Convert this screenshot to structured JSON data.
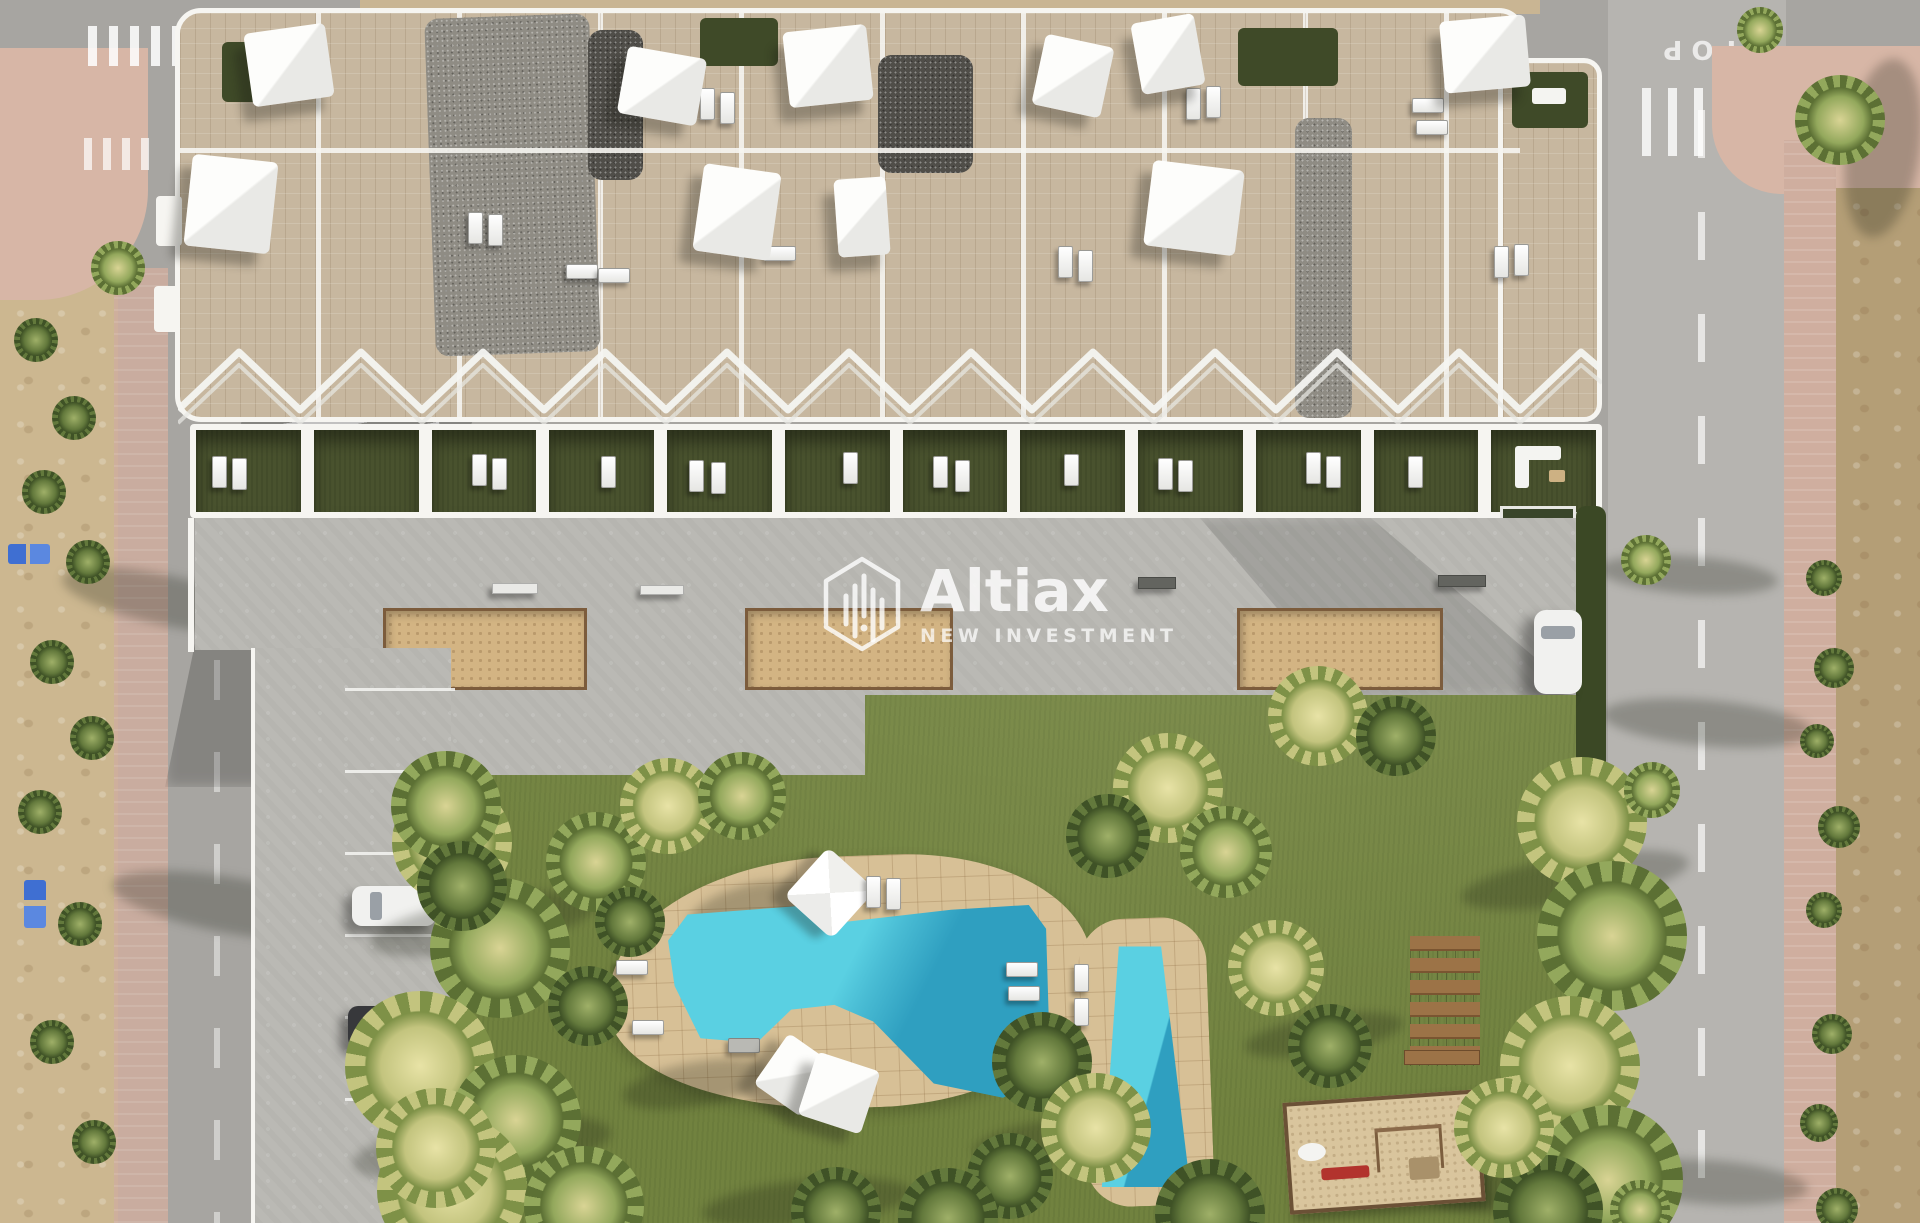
{
  "image_type": "aerial 3D architectural render (bird's-eye view)",
  "subject": "Residential apartment complex with rooftop terraces, private rear gardens, communal paved terrace, lawn with freeform pool and children's pool, playground, parking bays and surrounding streets next to an empty dirt plot",
  "watermark": {
    "brand": "Altiax",
    "tagline": "NEW INVESTMENT",
    "logo_icon": "hexagon-bars-logo-icon"
  },
  "road_markings": {
    "stop": "STOP"
  },
  "features": [
    "white shade sails on rooftop terraces",
    "gravel flat-roof sections",
    "green rooftop garden patches",
    "zigzag white pergola over ground-floor gardens",
    "private garden plots with sun loungers",
    "three sand petanque courts on communal terrace",
    "freeform turquoise swimming pool on stone deck",
    "children's pool",
    "wooden stepping-plank paths",
    "playground with swing frame and red bench",
    "parking bays with white and dark car",
    "white car parked by east street",
    "palm trees and hedges",
    "zebra crossings and STOP marking",
    "undeveloped dirt lot on the east side",
    "blue waste bins on west sidewalk"
  ],
  "palette": {
    "asphalt": "#a7a5a1",
    "asphalt_light": "#b6b4b0",
    "sidewalk_pink": "#cfae9f",
    "plaza_pink": "#d7b6a6",
    "dirt": "#ccb790",
    "dirt_dark": "#b49e76",
    "concrete": "#bab9b4",
    "roof_tile": "#c7b79f",
    "gravel": "#8f8c84",
    "gravel_dark": "#504e49",
    "white_struct": "#f6f5f1",
    "garden_green": "#49522e",
    "lawn": "#71823f",
    "hedge": "#3b4825",
    "sand_court": "#d3b483",
    "court_border": "#7c5c3c",
    "deck_sand": "#d7c096",
    "pool": "#5ad0e2",
    "pool_deep": "#2f9fc0",
    "wood": "#9c7347",
    "car_white": "#f1f1ef",
    "car_dark": "#37383b",
    "bin_blue": "#3f6fd2",
    "play_sand": "#d9c59d",
    "play_red": "#b2332d",
    "palm_light": "#e8e3a6",
    "palm_mid": "#93a85c"
  }
}
